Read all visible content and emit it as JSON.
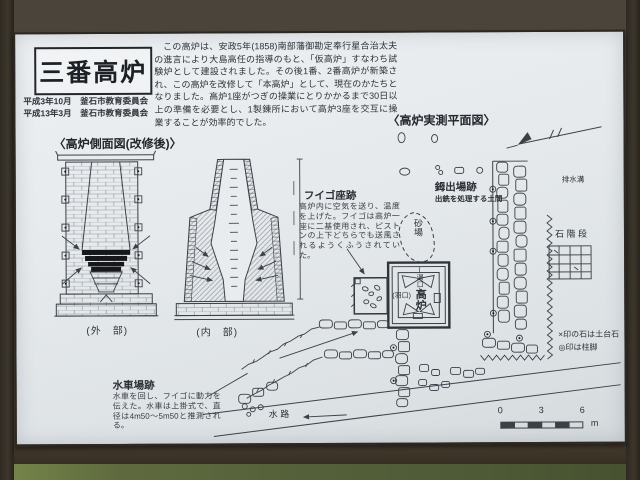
{
  "colors": {
    "board": "#e6eaec",
    "ink": "#2e3239",
    "background": "#48423a",
    "grass": "#5f6b3e",
    "frame": "#362e23"
  },
  "sign": {
    "title": "三番高炉",
    "credits": [
      "平成3年10月　釜石市教育委員会",
      "平成13年3月　釜石市教育委員会"
    ],
    "intro": "この高炉は、安政5年(1858)南部藩御勘定奉行星合治太夫の進言により大島高任の指導のもと、「仮高炉」すなわち試験炉として建設されました。その後1番、2番高炉が新築され、この高炉を改修して「本高炉」として、現在のかたちとなりました。高炉1座がつぎの操業にとりかかるまで30日以上の準備を必要とし、1製錬所において高炉3座を交互に操業することが効率的でした。",
    "side_view": {
      "heading": "〈高炉側面図(改修後)〉",
      "exterior_label": "(外　部)",
      "interior_label": "(内　部)"
    },
    "plan_view": {
      "heading": "〈高炉実測平面図〉",
      "fuigo": {
        "label": "フイゴ座跡",
        "desc": "高炉内に空気を送り、温度を上げた。フイゴは高炉一座に二基使用され、ピストンの上下どちらでも送風されるようくふうされていた。"
      },
      "kera": {
        "label": "鉧出場跡",
        "desc": "出銑を処理する土間"
      },
      "suisha": {
        "label": "水車場跡",
        "desc": "水車を回し、フイゴに動力を伝えた。水車は上掛式で、直径は4m50〜5m50と推測される。"
      },
      "sandpit": "砂場",
      "drain": "排水溝",
      "stairs": "石 階 段",
      "waterway": "水 路",
      "furnace": "高炉",
      "tap_hole": "(湯口)",
      "tuyere": "(羽口)",
      "legend": [
        "×印の石は土台石",
        "◎印は柱脚"
      ],
      "scale": {
        "ticks": [
          "0",
          "3",
          "6"
        ],
        "unit": "m"
      }
    }
  }
}
